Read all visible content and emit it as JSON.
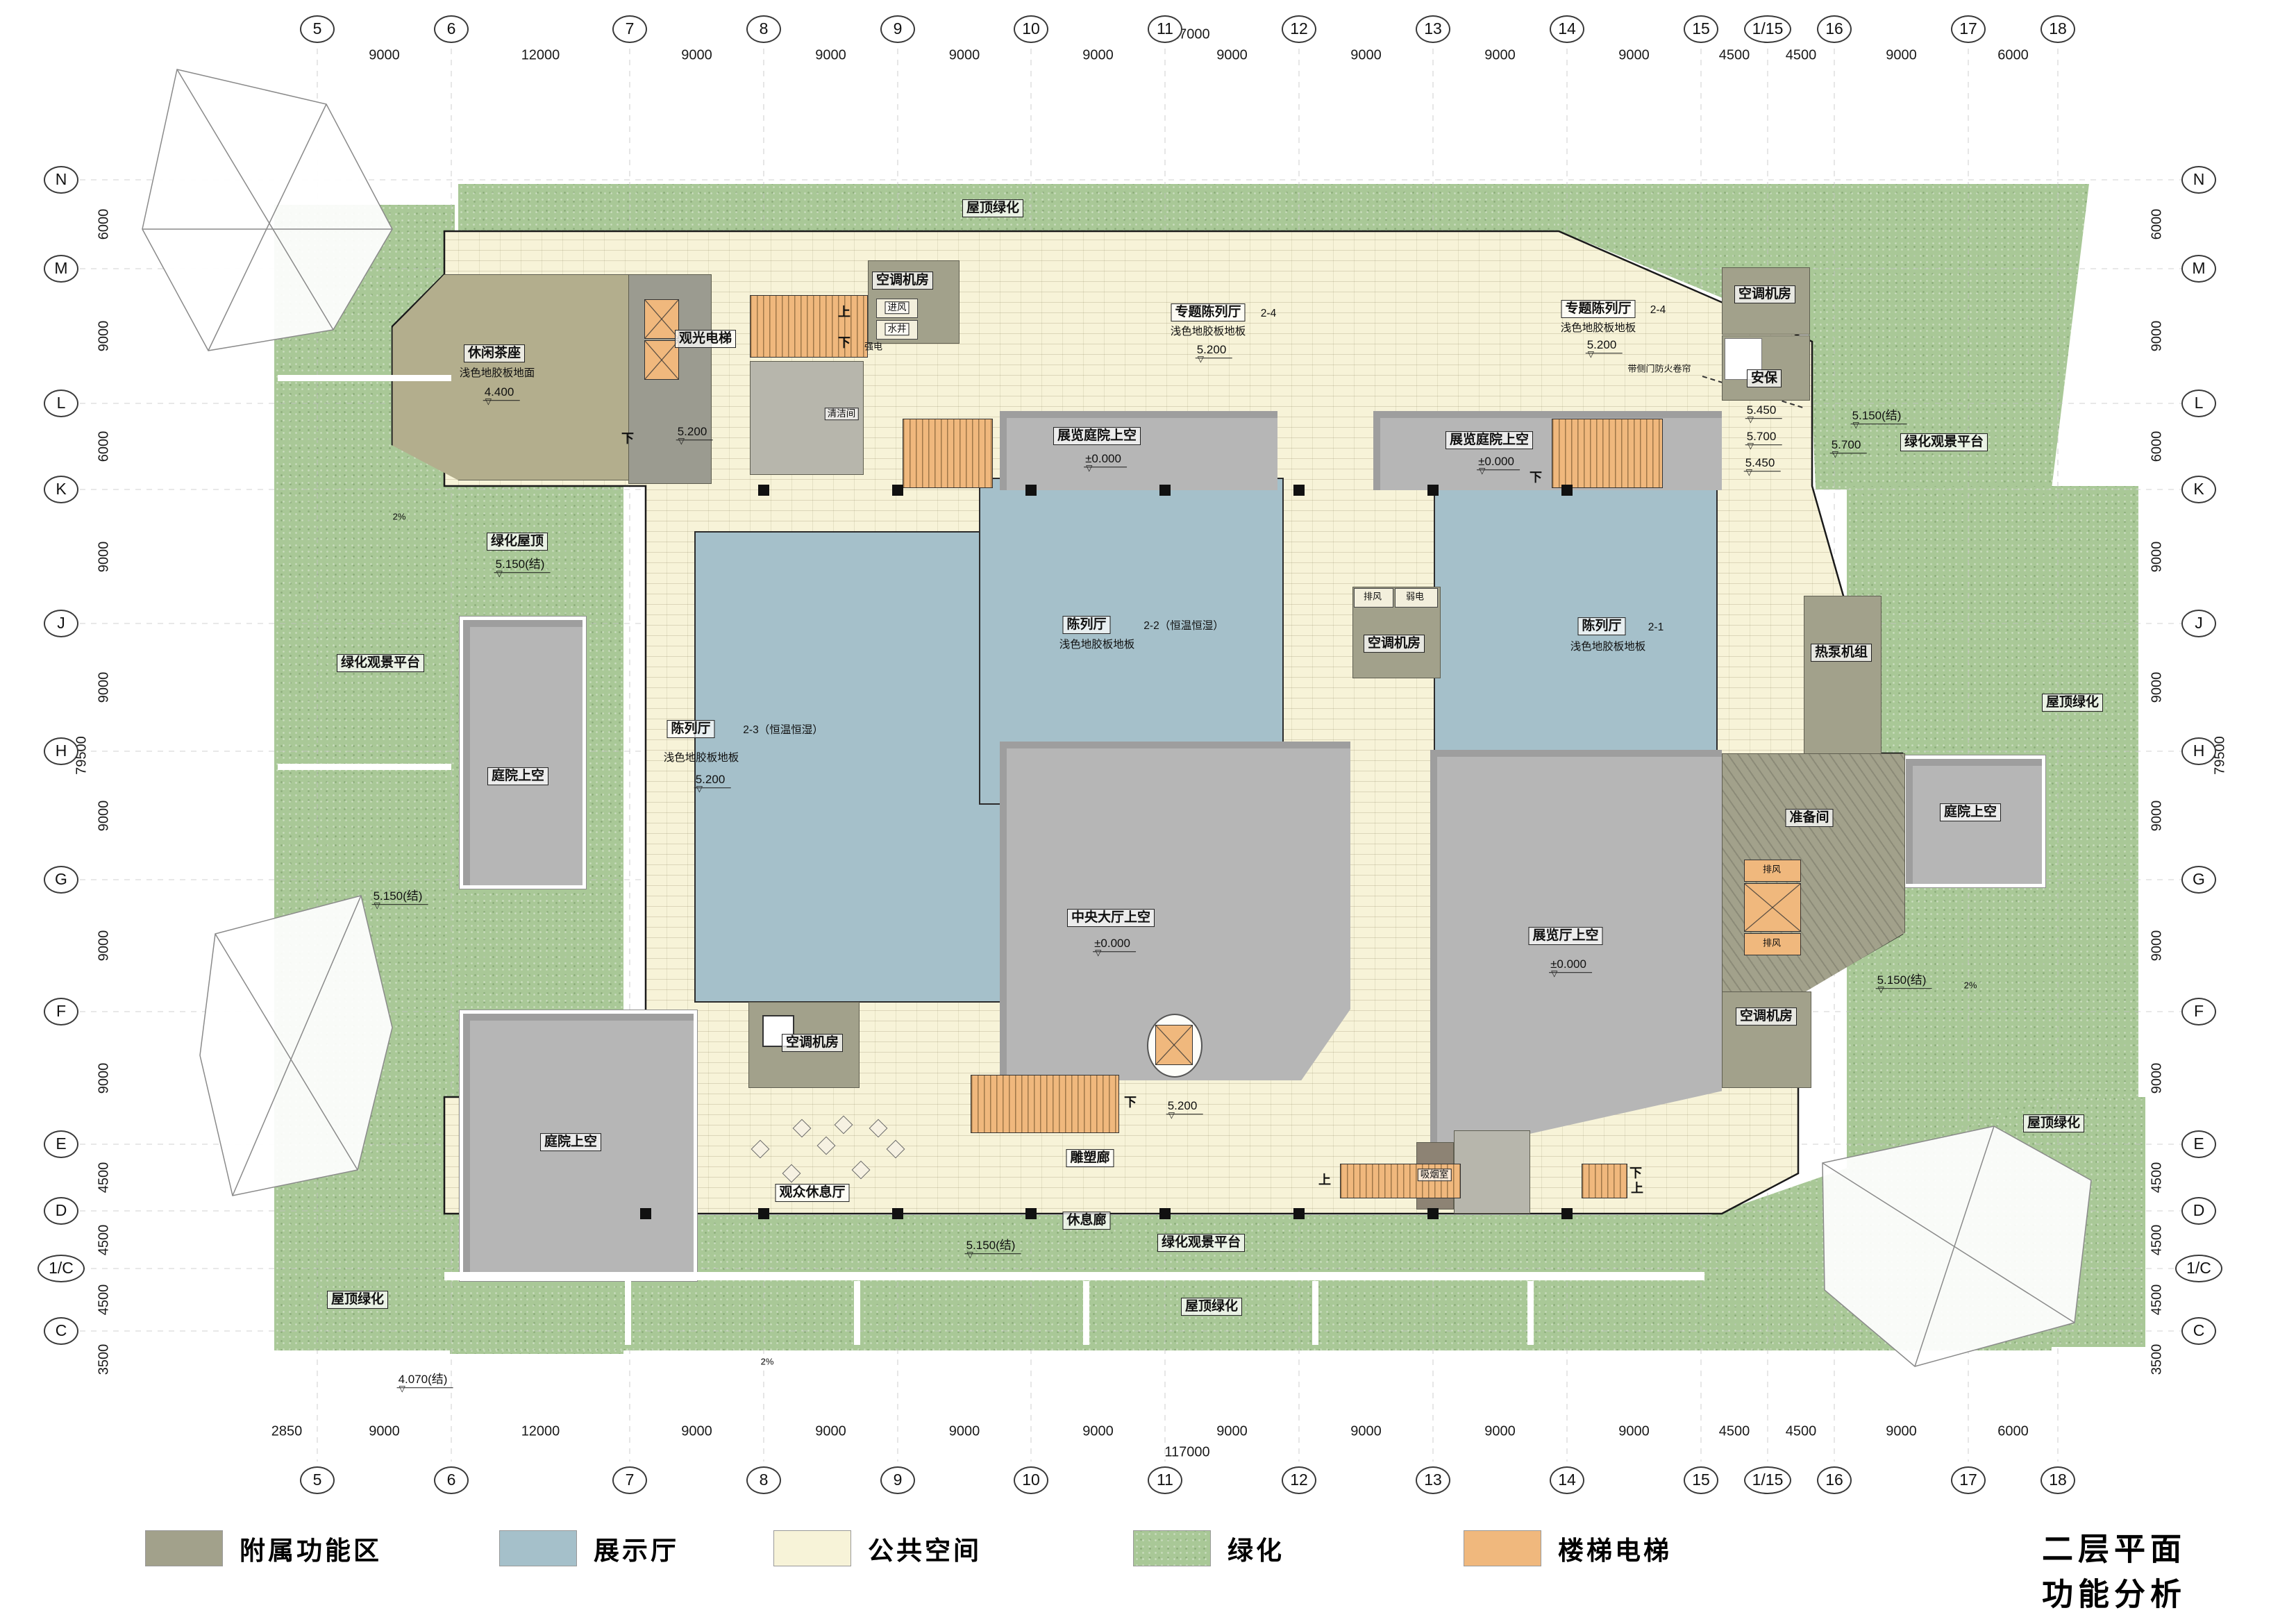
{
  "title": "二层平面功能分析图",
  "legend": [
    {
      "label": "附属功能区",
      "color": "#a2a18b"
    },
    {
      "label": "展示厅",
      "color": "#a5c0ca"
    },
    {
      "label": "公共空间",
      "color": "#f7f3d8"
    },
    {
      "label": "绿化",
      "color": "#a9c897"
    },
    {
      "label": "楼梯电梯",
      "color": "#f0b87d"
    }
  ],
  "grid": {
    "total_width": "117000",
    "total_height": "79500",
    "offset": "2850",
    "columns": [
      "5",
      "6",
      "7",
      "8",
      "9",
      "10",
      "11",
      "12",
      "13",
      "14",
      "15",
      "1/15",
      "16",
      "17",
      "18"
    ],
    "column_dims": [
      "9000",
      "12000",
      "9000",
      "9000",
      "9000",
      "9000",
      "9000",
      "9000",
      "9000",
      "9000",
      "4500",
      "4500",
      "9000",
      "6000"
    ],
    "rows": [
      "N",
      "M",
      "L",
      "K",
      "J",
      "H",
      "G",
      "F",
      "E",
      "D",
      "1/C",
      "C"
    ],
    "row_dims": [
      "6000",
      "9000",
      "6000",
      "9000",
      "9000",
      "9000",
      "9000",
      "9000",
      "4500",
      "4500",
      "4500",
      "3500"
    ]
  },
  "rooms": {
    "tea": "休闲茶座",
    "teaFloor": "浅色地胶板地面",
    "sightLift": "观光电梯",
    "ac": "空调机房",
    "security": "安保",
    "special": "专题陈列厅",
    "specialNo": "2-4",
    "hall": "陈列厅",
    "hall23No": "2-3（恒温恒湿）",
    "hall22No": "2-2（恒温恒湿）",
    "hall21No": "2-1",
    "floor": "浅色地胶板地板",
    "exhibCourtSky": "展览庭院上空",
    "centralSky": "中央大厅上空",
    "exhibSky": "展览厅上空",
    "courtSky": "庭院上空",
    "prep": "准备间",
    "heatPump": "热泵机组",
    "exhaust": "排风",
    "weakElec": "弱电",
    "strongElec": "强电",
    "intake": "进风",
    "well": "水井",
    "cleaning": "清洁间",
    "sculpture": "雕塑廊",
    "restCorridor": "休息廊",
    "lounge": "观众休息厅",
    "smoking": "吸烟室",
    "greenRoof": "绿化屋顶",
    "greenPlatform": "绿化观景平台",
    "roofGreen": "屋顶绿化"
  },
  "levels": {
    "l5200": "5.200",
    "l5150": "5.150(结)",
    "l4070": "4.070(结)",
    "l5450": "5.450",
    "l5700": "5.700",
    "l4400": "4.400",
    "l0": "±0.000"
  },
  "marks": {
    "up": "上",
    "down": "下",
    "slope": "2%",
    "fireShutter": "带侧门防火卷帘"
  }
}
